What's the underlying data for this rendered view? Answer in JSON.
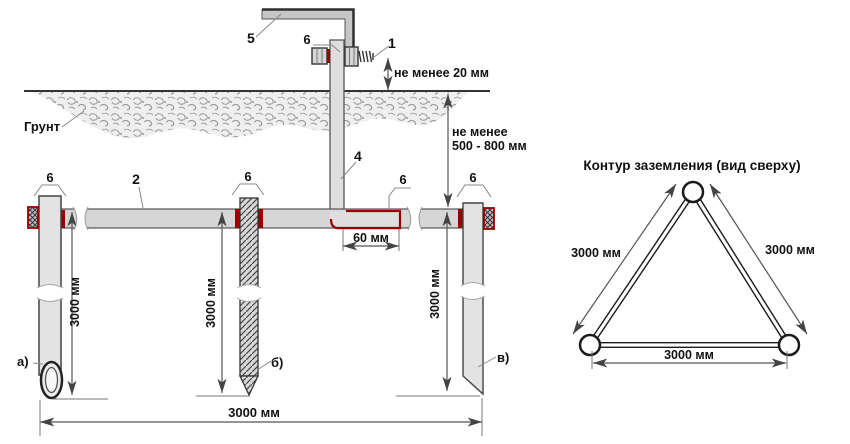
{
  "figure": {
    "labels": {
      "n1": "1",
      "n2": "2",
      "n4": "4",
      "n5": "5",
      "n6": "6",
      "ground": "Грунт",
      "electrode_a": "а)",
      "electrode_b": "б)",
      "electrode_v": "в)"
    },
    "dimensions": {
      "min20": "не менее 20 мм",
      "min500_line1": "не менее",
      "min500_line2": "500 - 800 мм",
      "overlap60": "60 мм",
      "depth3000": "3000 мм",
      "spacing3000": "3000 мм"
    },
    "top_view": {
      "title": "Контур заземления (вид сверху)",
      "side_left": "3000 мм",
      "side_right": "3000 мм",
      "side_bottom": "3000 мм"
    },
    "colors": {
      "label_red": "#cc1111",
      "weld_red": "#990000",
      "steel_gray": "#d6d6d6"
    }
  }
}
